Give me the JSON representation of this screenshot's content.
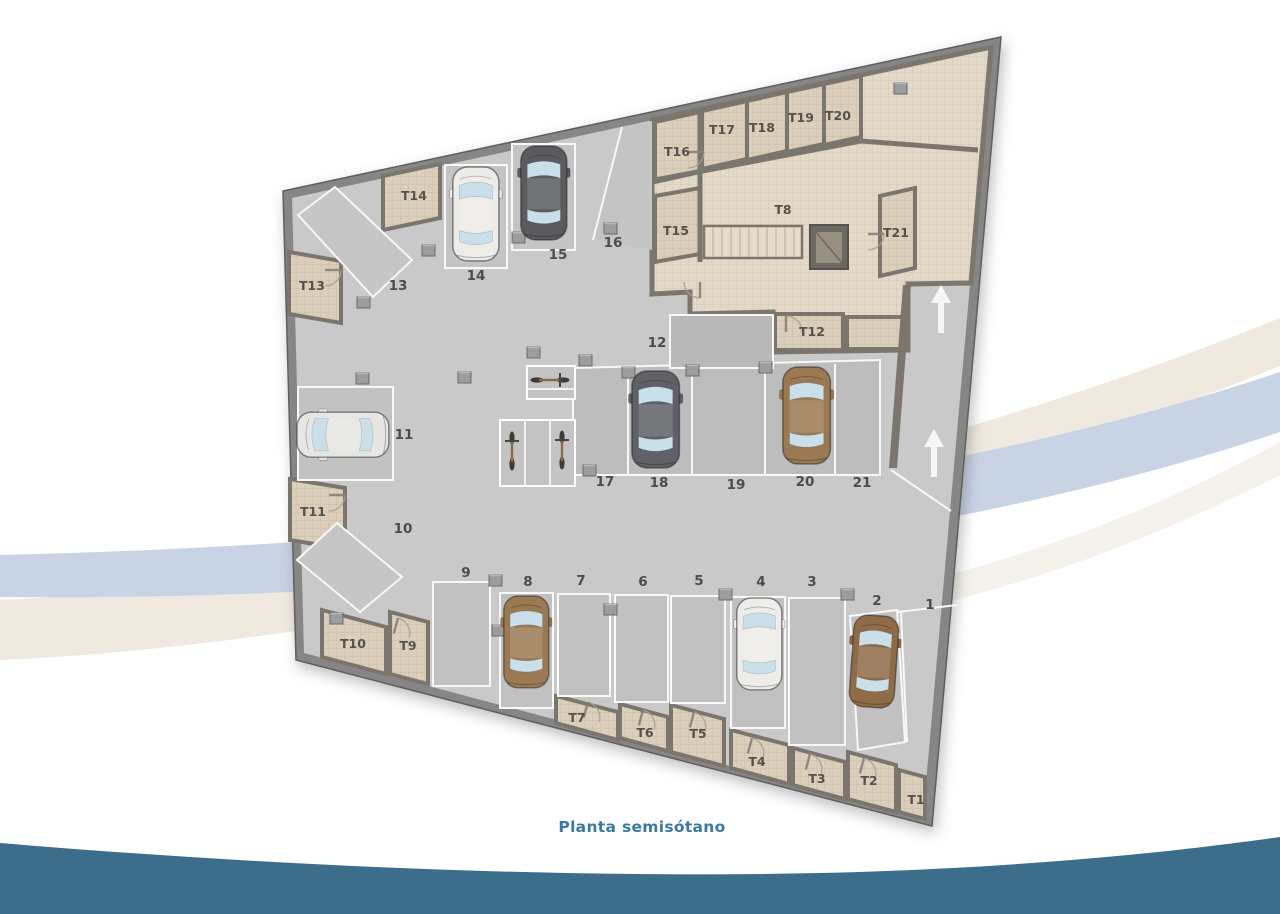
{
  "caption": "Planta semisótano",
  "plan": {
    "parking_labels": [
      "1",
      "2",
      "3",
      "4",
      "5",
      "6",
      "7",
      "8",
      "9",
      "10",
      "11",
      "12",
      "13",
      "14",
      "15",
      "16",
      "17",
      "18",
      "19",
      "20",
      "21"
    ],
    "storage_labels": [
      "T1",
      "T2",
      "T3",
      "T4",
      "T5",
      "T6",
      "T7",
      "T8",
      "T9",
      "T10",
      "T11",
      "T12",
      "T13",
      "T14",
      "T15",
      "T16",
      "T17",
      "T18",
      "T19",
      "T20",
      "T21"
    ],
    "occupied_spaces": [
      "2",
      "4",
      "8",
      "11",
      "14",
      "15",
      "18",
      "20"
    ],
    "bicycle_count": 3,
    "ramp_arrow_count": 2
  },
  "colors": {
    "caption_text": "#3a7aa2",
    "teal_wave": "#3c6d8b",
    "blue_band": "#c8d3e5",
    "cream_band": "#efe9df",
    "wall": "#868686",
    "parking_floor": "#c9c9c9",
    "stall_floor": "#bfbfbf",
    "tile_floor": "#e3d9c9",
    "storage_floor": "#dbcfbb",
    "car_brown": "#9b7a53",
    "car_dark": "#606166",
    "car_white": "#edece8",
    "car_silver": "#e6e6e2"
  }
}
